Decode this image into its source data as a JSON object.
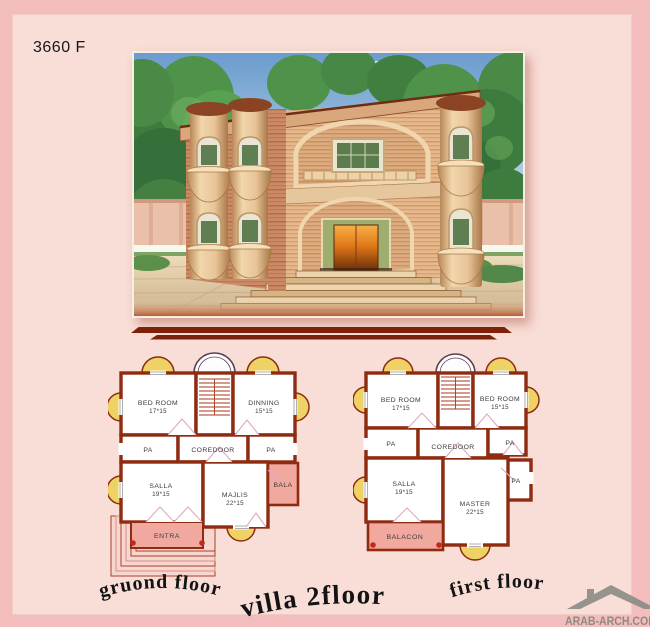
{
  "page": {
    "ref_code": "3660 F",
    "background": "#f3bdbd",
    "panel": "#f8ded7"
  },
  "title": {
    "text": "villa 2floor"
  },
  "watermark": {
    "text": "ARAB-ARCH.COM"
  },
  "colors": {
    "wall": "#8e2b10",
    "annex_pink": "#f1a99f",
    "balcony_yellow": "#eed266",
    "divider": "#7c2209"
  },
  "ground_floor": {
    "caption": "gruond floor",
    "rooms": {
      "bedroom": {
        "label": "BED ROOM",
        "size": "17*15"
      },
      "dining": {
        "label": "DINNING",
        "size": "15*15"
      },
      "pa_left": {
        "label": "PA"
      },
      "corridor": {
        "label": "COREDOOR"
      },
      "pa_right": {
        "label": "PA"
      },
      "salla": {
        "label": "SALLA",
        "size": "19*15"
      },
      "majlis": {
        "label": "MAJLIS",
        "size": "22*15"
      },
      "bala": {
        "label": "BALA"
      },
      "entra": {
        "label": "ENTRA"
      }
    }
  },
  "first_floor": {
    "caption": "first floor",
    "rooms": {
      "bedroom_left": {
        "label": "BED ROOM",
        "size": "17*15"
      },
      "bedroom_right": {
        "label": "BED ROOM",
        "size": "15*15"
      },
      "pa_left": {
        "label": "PA"
      },
      "corridor": {
        "label": "COREDOOR"
      },
      "pa_right": {
        "label": "PA"
      },
      "pa_lower": {
        "label": "PA"
      },
      "salla": {
        "label": "SALLA",
        "size": "19*15"
      },
      "master": {
        "label": "MASTER",
        "size": "22*15"
      },
      "balacon": {
        "label": "BALACON"
      }
    }
  }
}
